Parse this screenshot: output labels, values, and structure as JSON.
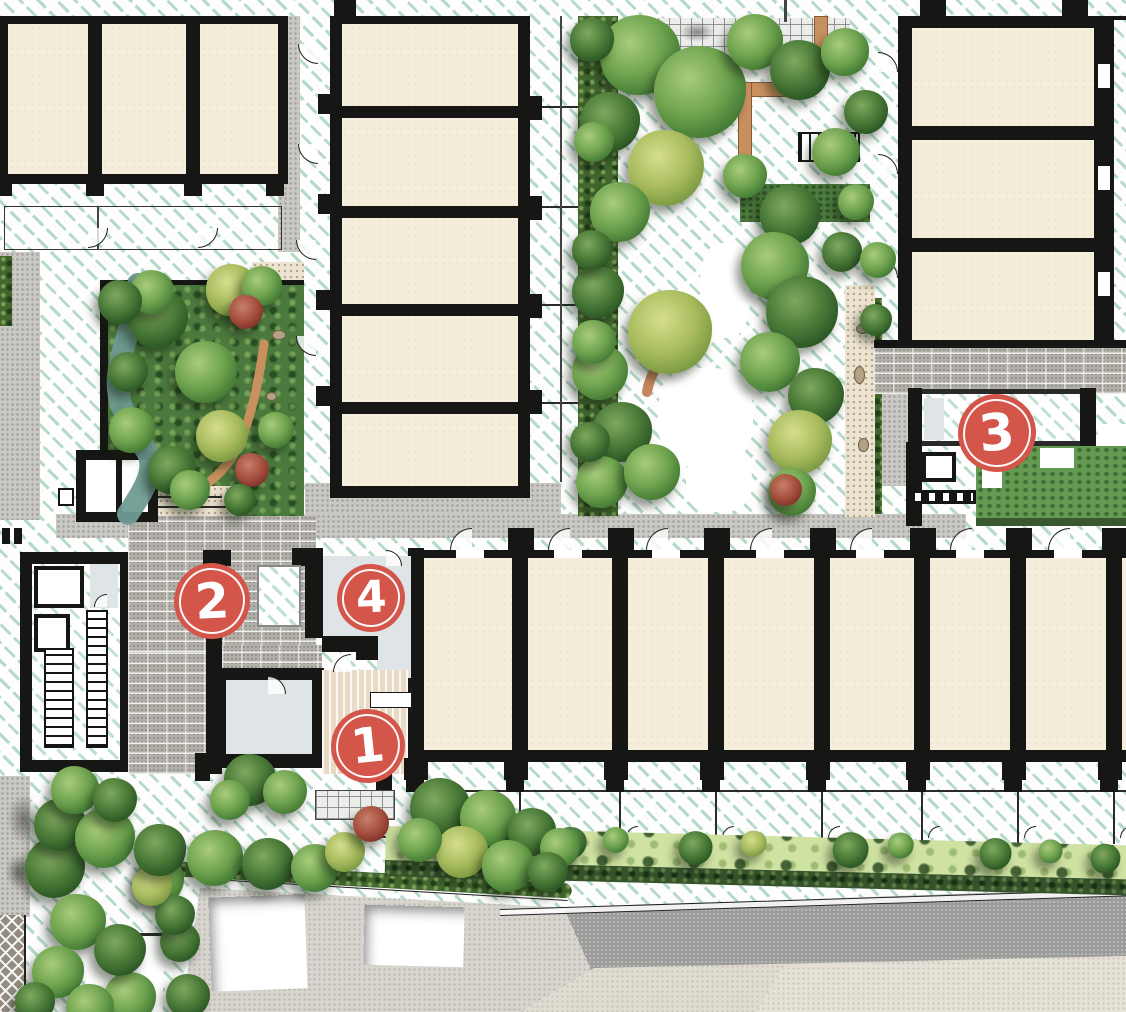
{
  "title": "Landscape architecture site plan with numbered key locations",
  "markers": [
    {
      "label": "1",
      "x": 368,
      "y": 746,
      "r": 37
    },
    {
      "label": "2",
      "x": 212,
      "y": 601,
      "r": 38
    },
    {
      "label": "3",
      "x": 997,
      "y": 433,
      "r": 39
    },
    {
      "label": "4",
      "x": 371,
      "y": 598,
      "r": 34
    }
  ],
  "colors": {
    "marker_red": "#d45549",
    "hatch_teal": "#7abca2",
    "room_cream": "#f6eedc",
    "wall_black": "#161614",
    "foliage_green": "#4a7a38",
    "lawn_light": "#cfe2a2",
    "terracotta": "#c9905f",
    "paving_gray": "#cac8c3",
    "road_gray": "#9b9b99"
  }
}
